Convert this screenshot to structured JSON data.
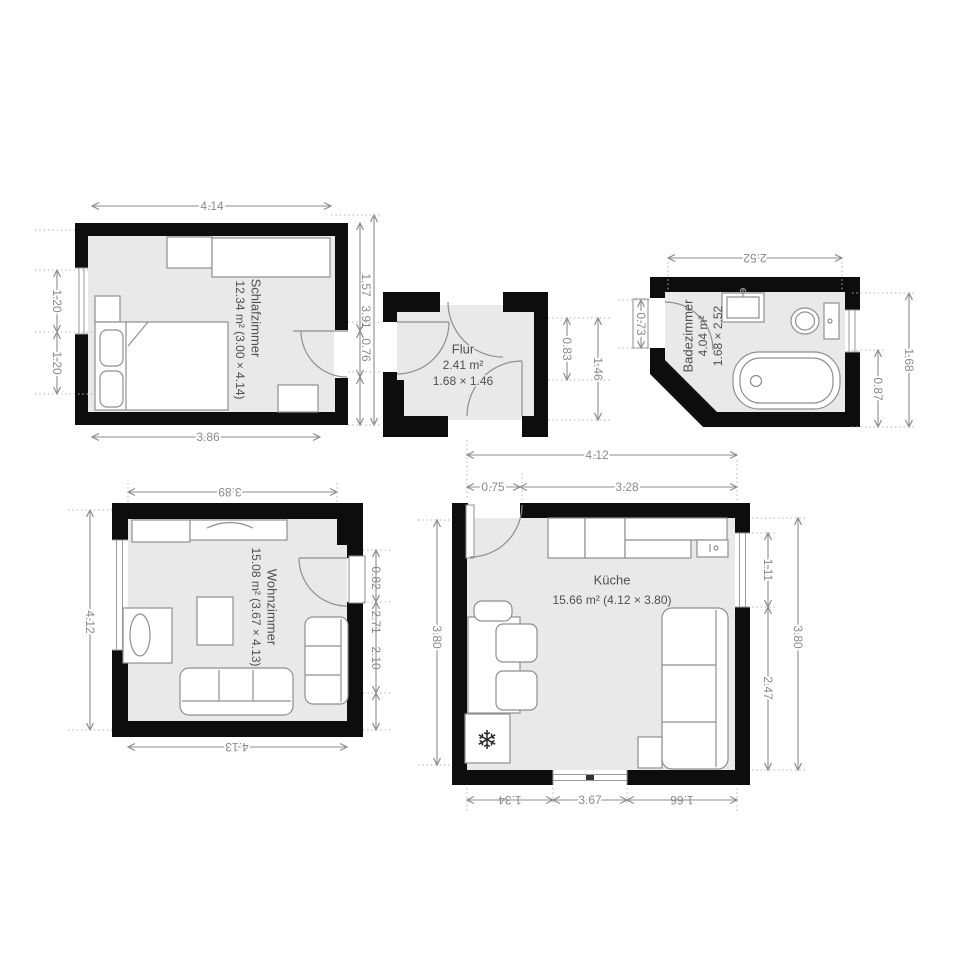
{
  "rooms": {
    "schlafzimmer": {
      "name": "Schlafzimmer",
      "area": "12.34 m² (3.00 × 4.14)"
    },
    "flur": {
      "name": "Flur",
      "area": "2.41 m²",
      "size": "1.68 × 1.46"
    },
    "badezimmer": {
      "name": "Badezimmer",
      "area": "4.04 m²",
      "size": "1.68 × 2.52"
    },
    "wohnzimmer": {
      "name": "Wohnzimmer",
      "area": "15.08 m² (3.67 × 4.13)"
    },
    "kueche": {
      "name": "Küche",
      "area": "15.66 m² (4.12 × 3.80)"
    }
  },
  "dimensions": {
    "schlafzimmer": {
      "top": "4.14",
      "bottom": "3.86",
      "left_upper": "1.20",
      "left_lower": "1.20",
      "right_upper": "1.57",
      "right_total": "3.91",
      "right_door": "0.76"
    },
    "flur": {
      "right_inner": "0.83",
      "right_outer": "1.46"
    },
    "badezimmer": {
      "top": "2.52",
      "left_door": "0.73",
      "right_lower": "0.87",
      "right_total": "1.68"
    },
    "wohnzimmer": {
      "top": "3.89",
      "bottom": "4.13",
      "left": "4.12",
      "right_door": "0.82",
      "right_mid": "2.71",
      "right_lower": "2.10"
    },
    "kueche": {
      "top_total": "4.12",
      "top_door": "0.75",
      "top_main": "3.28",
      "left": "3.80",
      "right_window": "1.11",
      "right_lower": "2.47",
      "right_total": "3.80",
      "bottom_left": "1.34",
      "bottom_mid": "3.67",
      "bottom_right": "1.66"
    }
  },
  "icons": {
    "freezer": {
      "name": "snowflake-icon",
      "glyph": "❄"
    }
  },
  "colors": {
    "wall": "#0d0d0d",
    "floor": "#e9e9e9",
    "dim_line": "#8d8d8d",
    "dim_text": "#8a8a8a",
    "label_text": "#4f4f4f",
    "furniture_stroke": "#8f8f8f"
  }
}
